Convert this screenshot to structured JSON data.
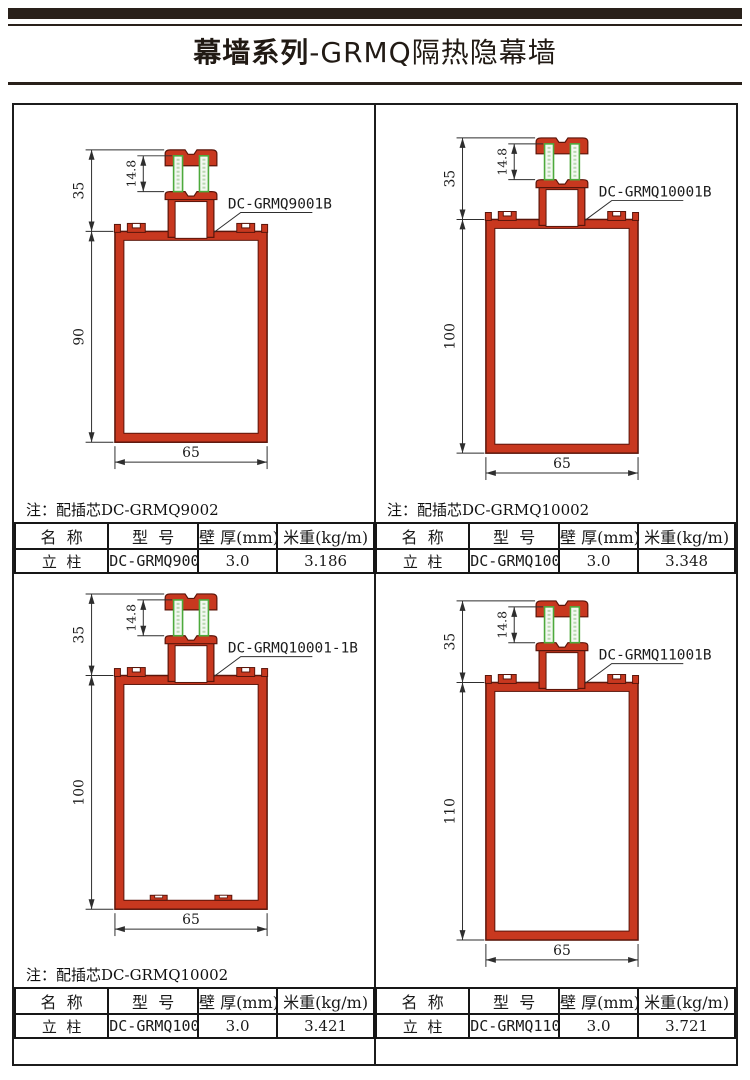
{
  "header": {
    "series": "幕墙系列",
    "product": "-GRMQ隔热隐幕墙"
  },
  "colors": {
    "profile_red": "#c8381f",
    "profile_outline": "#5a150a",
    "thermal_green": "#4daa3c",
    "thermal_fill": "#f3f8f1",
    "line": "#2e2e2e",
    "bar": "#29201a",
    "table_border": "#161616"
  },
  "table_headers": [
    "名  称",
    "型  号",
    "壁 厚(mm)",
    "米重(kg/m)"
  ],
  "quadrants": [
    {
      "label": "DC-GRMQ9001B",
      "note": "注：配插芯DC-GRMQ9002",
      "dims": {
        "top": "35",
        "strip": "14.8",
        "body": "90",
        "width": "65"
      },
      "row": {
        "name": "立  柱",
        "model": "DC-GRMQ9001",
        "wall_thickness": "3.0",
        "meter_weight": "3.186"
      },
      "bottom_notches": false
    },
    {
      "label": "DC-GRMQ10001B",
      "note": "注：配插芯DC-GRMQ10002",
      "dims": {
        "top": "35",
        "strip": "14.8",
        "body": "100",
        "width": "65"
      },
      "row": {
        "name": "立  柱",
        "model": "DC-GRMQ10001",
        "wall_thickness": "3.0",
        "meter_weight": "3.348"
      },
      "bottom_notches": false
    },
    {
      "label": "DC-GRMQ10001-1B",
      "note": "注：配插芯DC-GRMQ10002",
      "dims": {
        "top": "35",
        "strip": "14.8",
        "body": "100",
        "width": "65"
      },
      "row": {
        "name": "立  柱",
        "model": "DC-GRMQ10001-1",
        "wall_thickness": "3.0",
        "meter_weight": "3.421"
      },
      "bottom_notches": true
    },
    {
      "label": "DC-GRMQ11001B",
      "note": "",
      "dims": {
        "top": "35",
        "strip": "14.8",
        "body": "110",
        "width": "65"
      },
      "row": {
        "name": "立  柱",
        "model": "DC-GRMQ11001",
        "wall_thickness": "3.0",
        "meter_weight": "3.721"
      },
      "bottom_notches": false
    }
  ]
}
